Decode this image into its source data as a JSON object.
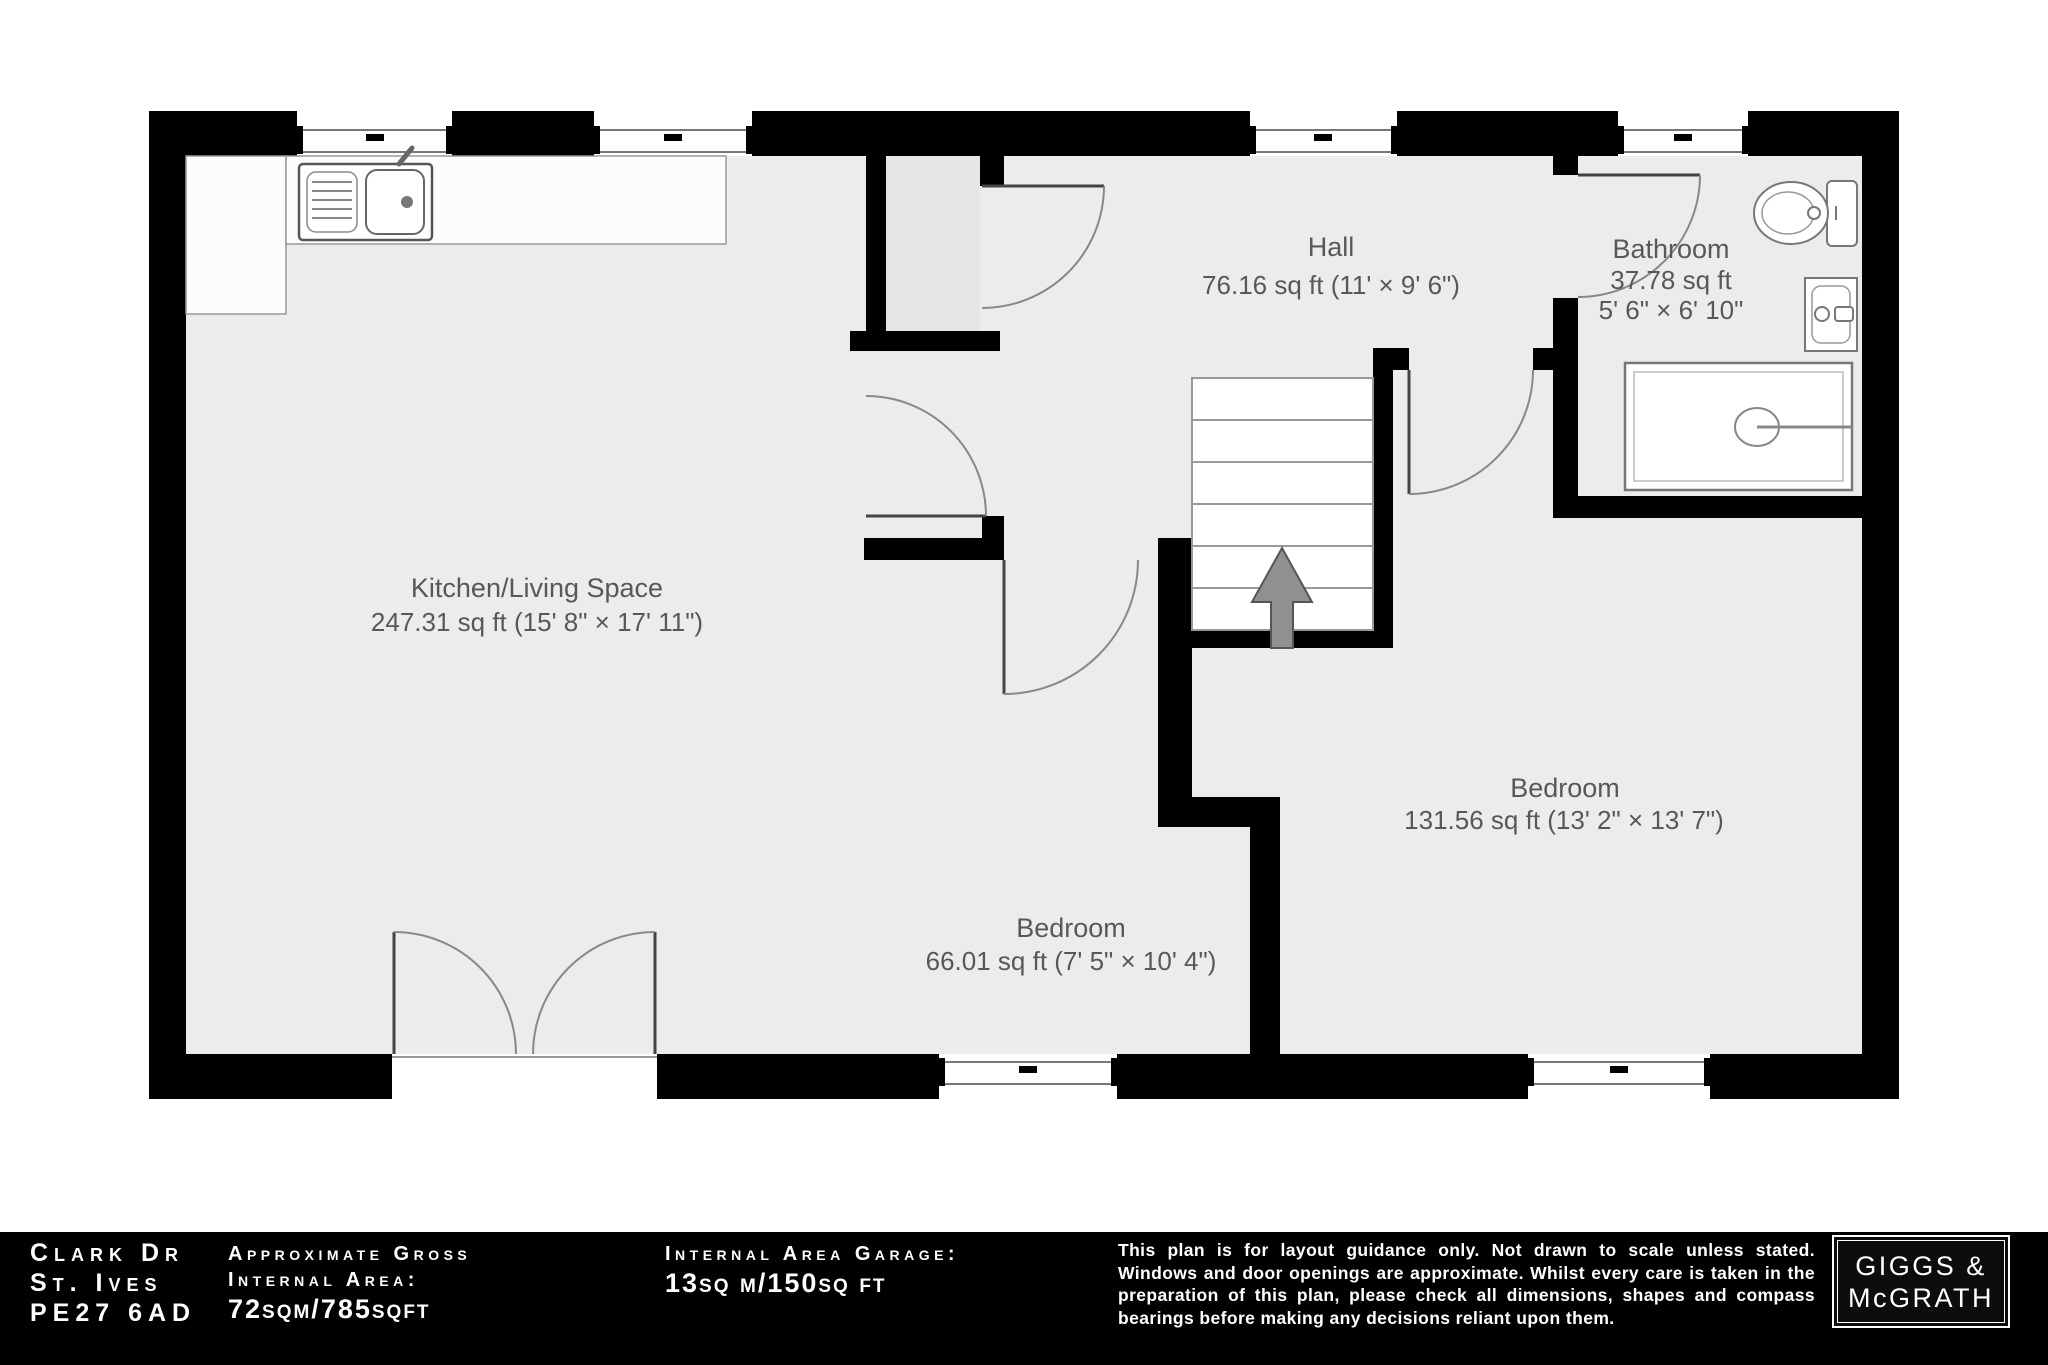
{
  "plan": {
    "rooms": {
      "kitchen": {
        "name": "Kitchen/Living Space",
        "dims": "247.31 sq ft (15' 8\" × 17' 11\")"
      },
      "hall": {
        "name": "Hall",
        "dims": "76.16 sq ft (11' × 9' 6\")"
      },
      "bathroom": {
        "name": "Bathroom",
        "area": "37.78 sq ft",
        "dims": "5' 6\" × 6' 10\""
      },
      "bedroom_small": {
        "name": "Bedroom",
        "dims": "66.01 sq ft (7' 5\" × 10' 4\")"
      },
      "bedroom_large": {
        "name": "Bedroom",
        "dims": "131.56 sq ft (13' 2\" × 13' 7\")"
      }
    },
    "fixtures": [
      "kitchen-sink",
      "toilet",
      "basin",
      "shower",
      "stairs",
      "up-arrow"
    ]
  },
  "footer": {
    "address": {
      "line1": "Clark Dr",
      "line2": "St. Ives",
      "line3": "PE27 6AD"
    },
    "gross": {
      "label1": "Approximate Gross",
      "label2": "Internal Area:",
      "value": "72sqm/785sqft"
    },
    "garage": {
      "label1": "Internal Area Garage:",
      "value": "13sq m/150sq ft"
    },
    "disclaimer": "This plan is for layout guidance only. Not drawn to scale unless stated. Windows and door openings are approximate. Whilst every care is taken in the preparation of this plan, please check all dimensions, shapes and compass bearings before making any decisions reliant upon them.",
    "brand": {
      "line1": "GIGGS &",
      "line2": "McGRATH"
    }
  },
  "colors": {
    "wall": "#000000",
    "floor": "#ececec",
    "closet_floor": "#e6e6e6",
    "label_text": "#58585a",
    "footer_bg": "#000000",
    "footer_text": "#ffffff"
  }
}
